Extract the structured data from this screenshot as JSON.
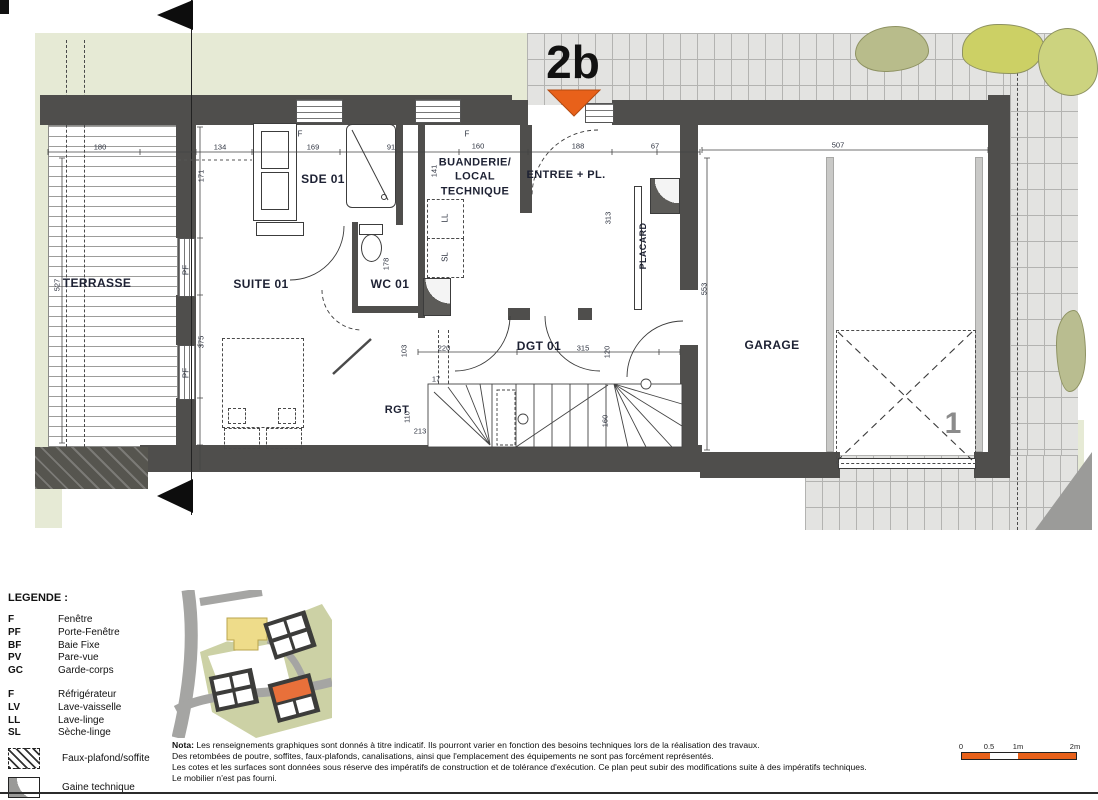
{
  "colors": {
    "accent_orange": "#e8611a",
    "wall": "#4f4e4c",
    "landscape_green": "#e6ead5",
    "paving": "#e3e3e1",
    "label_text": "#1d2133",
    "parking_gray": "#8b8b8b"
  },
  "title_marker": {
    "lot": "2b",
    "parking_space": "1"
  },
  "plan": {
    "rooms": [
      {
        "label": "TERRASSE",
        "x": 97,
        "y": 284,
        "fs": 12
      },
      {
        "label": "SUITE 01",
        "x": 261,
        "y": 285,
        "fs": 12
      },
      {
        "label": "SDE 01",
        "x": 323,
        "y": 180,
        "fs": 12
      },
      {
        "label": "WC 01",
        "x": 390,
        "y": 285,
        "fs": 12
      },
      {
        "label": "BUANDERIE/\nLOCAL\nTECHNIQUE",
        "x": 475,
        "y": 177,
        "fs": 11
      },
      {
        "label": "ENTREE + PL.",
        "x": 566,
        "y": 175,
        "fs": 11
      },
      {
        "label": "PLACARD",
        "x": 644,
        "y": 246,
        "fs": 9,
        "rot": 1
      },
      {
        "label": "DGT 01",
        "x": 539,
        "y": 347,
        "fs": 12
      },
      {
        "label": "RGT",
        "x": 397,
        "y": 410,
        "fs": 11
      },
      {
        "label": "GARAGE",
        "x": 772,
        "y": 346,
        "fs": 12
      }
    ],
    "dims": [
      {
        "v": "180",
        "x": 100,
        "y": 147
      },
      {
        "v": "134",
        "x": 220,
        "y": 147
      },
      {
        "v": "169",
        "x": 313,
        "y": 147
      },
      {
        "v": "91",
        "x": 391,
        "y": 147
      },
      {
        "v": "160",
        "x": 478,
        "y": 146
      },
      {
        "v": "188",
        "x": 578,
        "y": 146
      },
      {
        "v": "67",
        "x": 655,
        "y": 146
      },
      {
        "v": "507",
        "x": 838,
        "y": 145
      },
      {
        "v": "220",
        "x": 444,
        "y": 348
      },
      {
        "v": "315",
        "x": 583,
        "y": 348
      },
      {
        "v": "17",
        "x": 436,
        "y": 379
      },
      {
        "v": "213",
        "x": 420,
        "y": 431
      },
      {
        "v": "527",
        "x": 57,
        "y": 285,
        "rot": 1
      },
      {
        "v": "171",
        "x": 201,
        "y": 176,
        "rot": 1
      },
      {
        "v": "375",
        "x": 201,
        "y": 342,
        "rot": 1
      },
      {
        "v": "141",
        "x": 434,
        "y": 171,
        "rot": 1
      },
      {
        "v": "178",
        "x": 386,
        "y": 264,
        "rot": 1
      },
      {
        "v": "313",
        "x": 608,
        "y": 218,
        "rot": 1
      },
      {
        "v": "553",
        "x": 704,
        "y": 289,
        "rot": 1
      },
      {
        "v": "103",
        "x": 404,
        "y": 351,
        "rot": 1
      },
      {
        "v": "110",
        "x": 407,
        "y": 417,
        "rot": 1
      },
      {
        "v": "120",
        "x": 607,
        "y": 352,
        "rot": 1
      },
      {
        "v": "160",
        "x": 605,
        "y": 421,
        "rot": 1
      }
    ],
    "openings": [
      {
        "v": "F",
        "x": 300,
        "y": 134
      },
      {
        "v": "F",
        "x": 467,
        "y": 134
      },
      {
        "v": "PF",
        "x": 186,
        "y": 270,
        "rot": 1
      },
      {
        "v": "PF",
        "x": 186,
        "y": 373,
        "rot": 1
      }
    ]
  },
  "legend": {
    "title": "LEGENDE :",
    "groups": [
      [
        {
          "code": "F",
          "label": "Fenêtre"
        },
        {
          "code": "PF",
          "label": "Porte-Fenêtre"
        },
        {
          "code": "BF",
          "label": "Baie Fixe"
        },
        {
          "code": "PV",
          "label": "Pare-vue"
        },
        {
          "code": "GC",
          "label": "Garde-corps"
        }
      ],
      [
        {
          "code": "F",
          "label": "Réfrigérateur"
        },
        {
          "code": "LV",
          "label": "Lave-vaisselle"
        },
        {
          "code": "LL",
          "label": "Lave-linge"
        },
        {
          "code": "SL",
          "label": "Sèche-linge"
        }
      ]
    ],
    "symbols": [
      {
        "icon": "hatch",
        "label": "Faux-plafond/soffite"
      },
      {
        "icon": "gaine",
        "label": "Gaine technique"
      }
    ]
  },
  "appliance_tags": [
    {
      "v": "LL",
      "x": 445,
      "y": 218
    },
    {
      "v": "SL",
      "x": 445,
      "y": 257
    }
  ],
  "nota": {
    "label": "Nota:",
    "lines": [
      "Les renseignements graphiques sont donnés à titre indicatif. Ils pourront varier en fonction des besoins techniques lors de la réalisation des travaux.",
      "Des retombées de poutre, soffites, faux-plafonds, canalisations, ainsi que l'emplacement des équipements ne sont pas forcément représentés.",
      "Les cotes et les surfaces sont données sous réserve des impératifs de construction et de tolérance d'exécution. Ce plan peut subir des modifications suite à des impératifs techniques.",
      "Le mobilier n'est pas fourni."
    ]
  },
  "scale_bar": {
    "labels": [
      {
        "t": "0",
        "x": 3
      },
      {
        "t": "0.5",
        "x": 31
      },
      {
        "t": "1m",
        "x": 60
      },
      {
        "t": "2m",
        "x": 117
      }
    ]
  }
}
